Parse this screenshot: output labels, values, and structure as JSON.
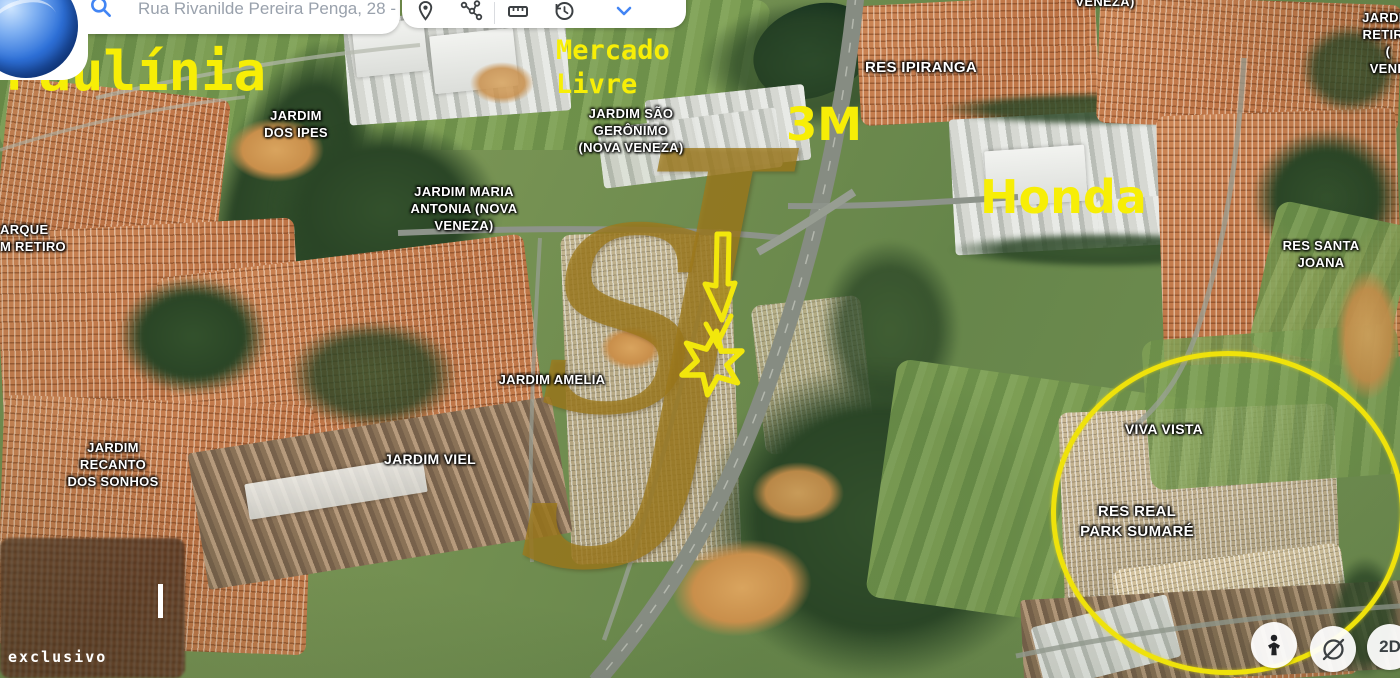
{
  "topbar": {
    "search": {
      "value": "Rua Rivanilde Pereira Penga, 28 -",
      "icon": "search-icon"
    },
    "icons": [
      "location-pin-icon",
      "route-icon",
      "ruler-icon",
      "history-icon",
      "chevron-down-icon"
    ]
  },
  "annotations": {
    "city": "Paulínia",
    "marketplace": "Mercado\nLivre",
    "company_3m": "3M",
    "company_honda": "Honda"
  },
  "map_labels": {
    "veneza_partial": "VENEZA)",
    "jardim_retiro_partial": "JARDIM\nRETIRO (\nVENE",
    "jardim_dos_ipes": "JARDIM\nDOS IPES",
    "jardim_sao_geronimo": "JARDIM SÃO\nGERÔNIMO\n(NOVA VENEZA)",
    "jardim_maria_antonia": "JARDIM MARIA\nANTONIA (NOVA\nVENEZA)",
    "res_ipiranga": "RES IPIRANGA",
    "parque_retiro_partial": "ARQUE\nM RETIRO",
    "res_santa_joana": "RES SANTA\nJOANA",
    "jardim_amelia": "JARDIM AMELIA",
    "jardim_viel": "JARDIM VIEL",
    "jardim_recanto": "JARDIM\nRECANTO\nDOS SONHOS",
    "viva_vista": "VIVA VISTA",
    "res_real_park": "RES REAL\nPARK SUMARÉ"
  },
  "watermark": {
    "initial_s": "S",
    "initial_j": "J",
    "credit": "exclusivo"
  },
  "controls": {
    "view_2d": "2D"
  },
  "colors": {
    "annotation_yellow": "#f7ee06",
    "circle_yellow": "#efe20b",
    "accent_blue": "#4285f4",
    "label_white": "#ffffff",
    "watermark_gold": "#9e7a1c"
  }
}
